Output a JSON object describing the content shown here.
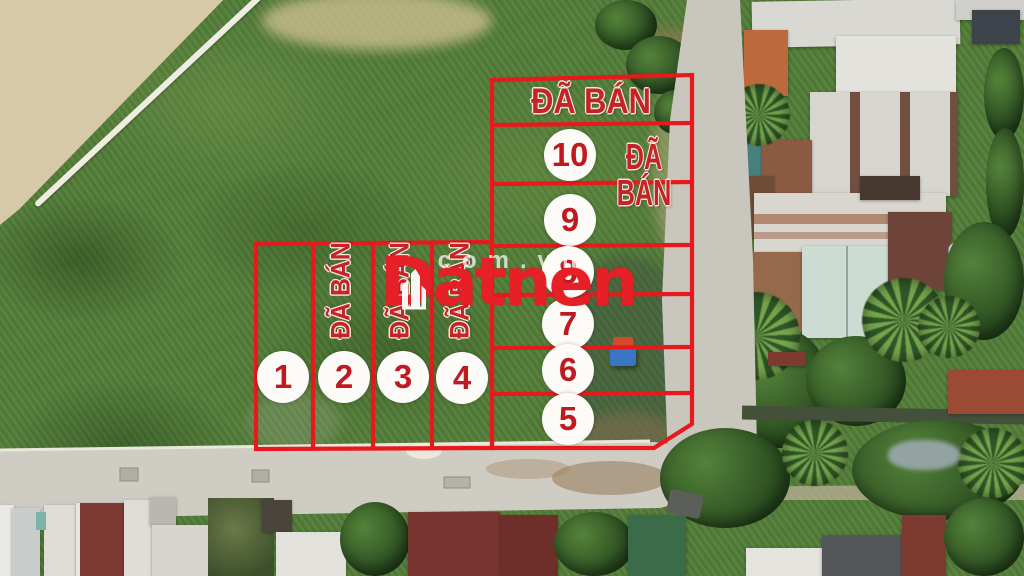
{
  "branding": {
    "logo_text": "Datnen",
    "watermark_text": ".com.vn",
    "logo_color": "#e71f26"
  },
  "plots": {
    "left_block": {
      "plots": [
        {
          "number": "1",
          "status_label": ""
        },
        {
          "number": "2",
          "status_label": "ĐÃ BÁN"
        },
        {
          "number": "3",
          "status_label": "ĐÃ BÁN"
        },
        {
          "number": "4",
          "status_label": "ĐÃ BÁN"
        }
      ]
    },
    "right_block": {
      "header_status": "ĐÃ BÁN",
      "row10_status": "ĐÃ BÁN",
      "plots": [
        {
          "number": "10"
        },
        {
          "number": "9"
        },
        {
          "number": "8"
        },
        {
          "number": "7"
        },
        {
          "number": "6"
        },
        {
          "number": "5"
        }
      ]
    },
    "boundary_color": "#e8191c",
    "sold_label_color": "#c62328",
    "number_color": "#bf1a20"
  }
}
